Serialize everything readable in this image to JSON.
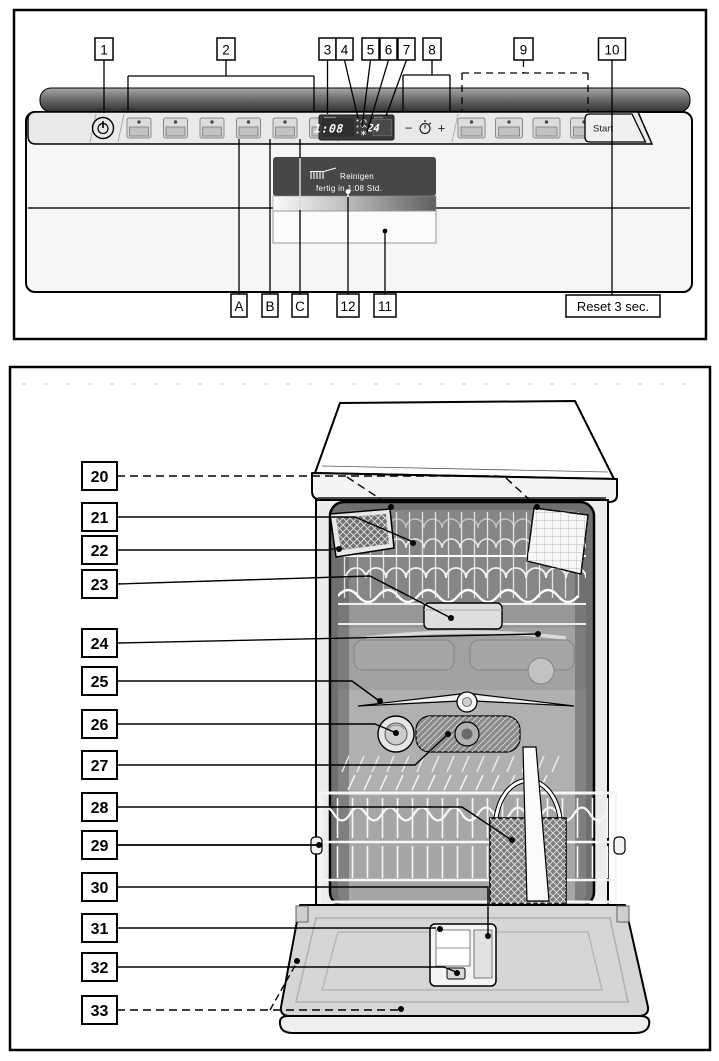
{
  "doc": {
    "figure1": {
      "callouts_top": [
        "1",
        "2",
        "3",
        "4",
        "5",
        "6",
        "7",
        "8",
        "9",
        "10"
      ],
      "callouts_bottom": [
        "A",
        "B",
        "C",
        "12",
        "11"
      ],
      "reset_note": "Reset 3 sec.",
      "start_label": "Start",
      "minus": "−",
      "plus": "+",
      "display": {
        "remaining_time": "1:08",
        "timer_preselect": "24"
      },
      "info_display": {
        "program": "Reinigen",
        "status": "fertig in 1:08 Std."
      },
      "icons": [
        "power-icon",
        "timer-clock-icon",
        "water-tap-indicator-icon",
        "salt-indicator-icon",
        "rinse-aid-indicator-icon",
        "cleaning-program-icon"
      ]
    },
    "figure2": {
      "callouts": [
        "20",
        "21",
        "22",
        "23",
        "24",
        "25",
        "26",
        "27",
        "28",
        "29",
        "30",
        "31",
        "32",
        "33"
      ]
    },
    "colors": {
      "ink": "#000000",
      "fascia": "#e9e9e9",
      "display_bg": "#3a3a3a",
      "info_display_bg": "#474747",
      "tub_gray": "#a8a8a8"
    }
  }
}
